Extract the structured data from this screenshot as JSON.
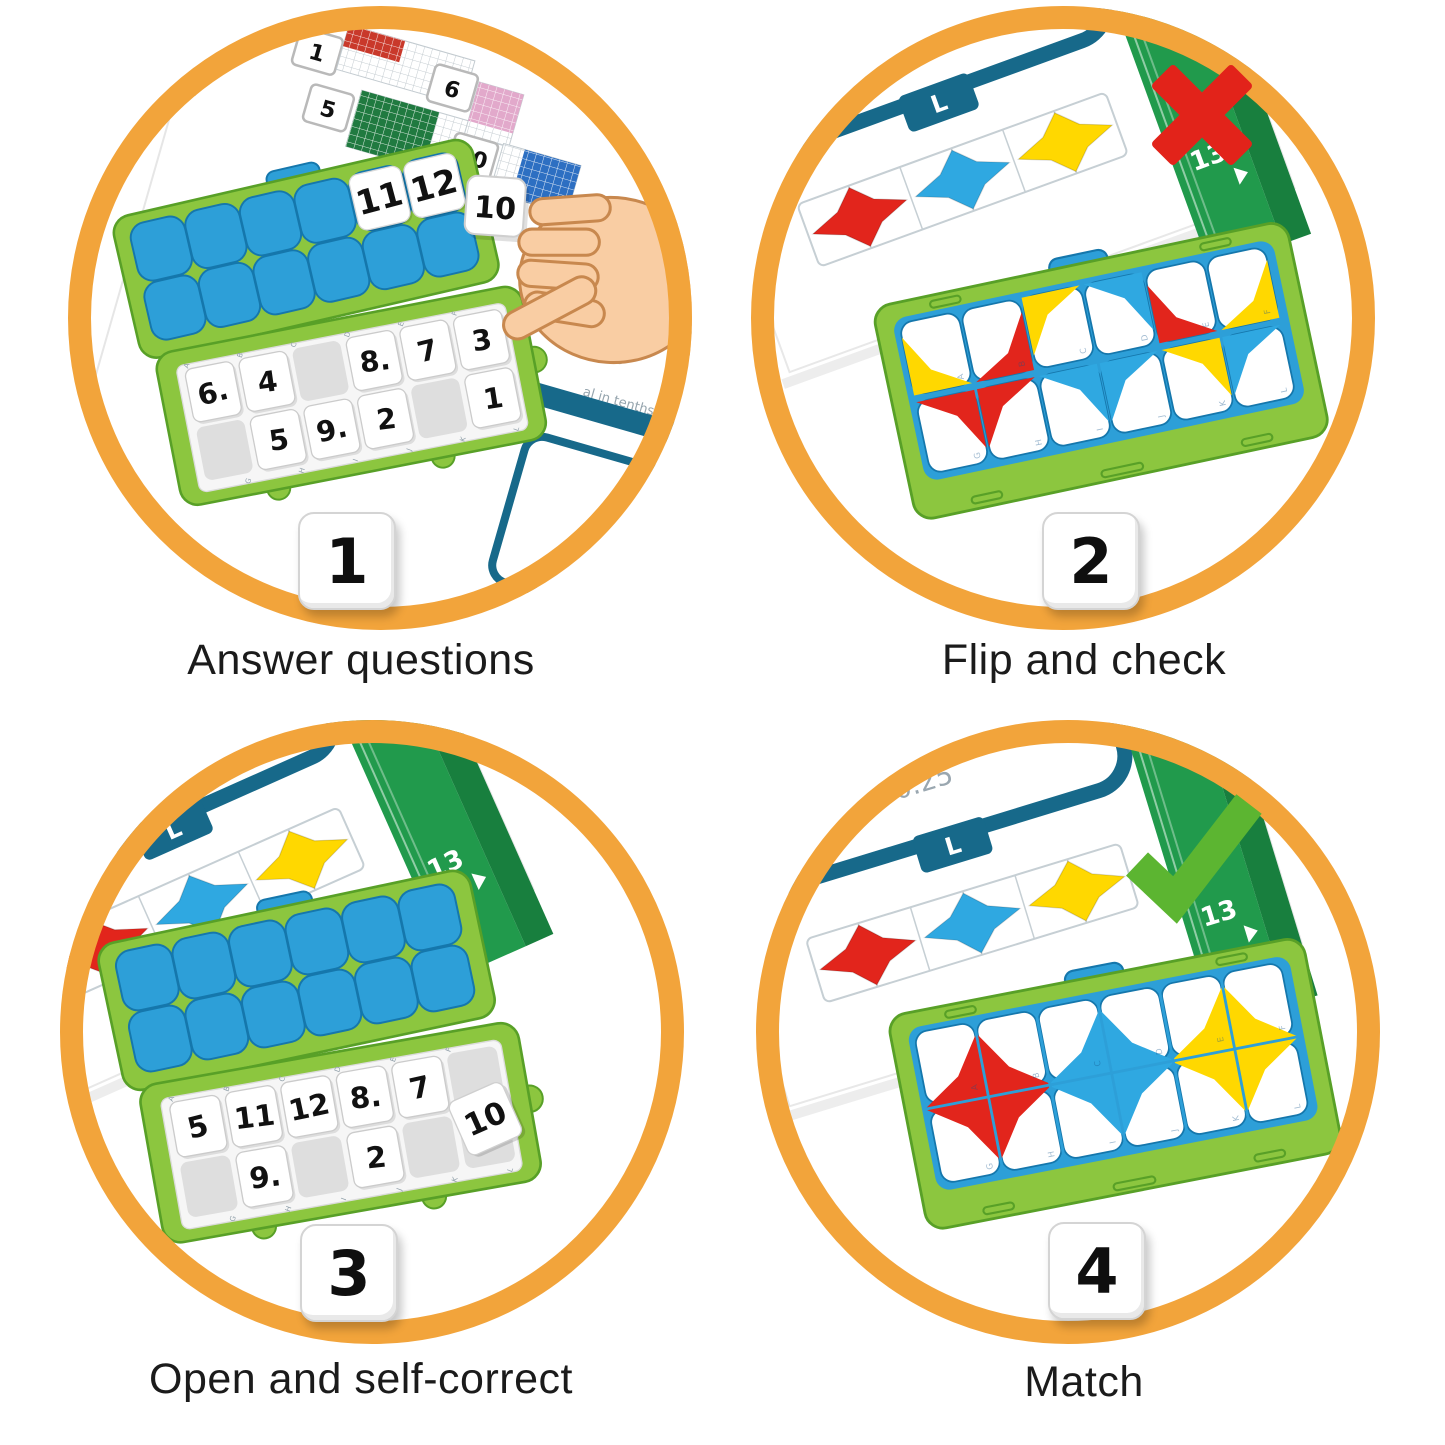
{
  "steps": [
    {
      "number": "1",
      "caption": "Answer questions"
    },
    {
      "number": "2",
      "caption": "Flip and check",
      "mark": "cross"
    },
    {
      "number": "3",
      "caption": "Open and self-correct"
    },
    {
      "number": "4",
      "caption": "Match",
      "mark": "check"
    }
  ],
  "colors": {
    "ring": "#F2A43B",
    "case_green": "#8CC63F",
    "case_green_dark": "#58A027",
    "lid_blue": "#2D9FD8",
    "lid_blue_dark": "#1577AC",
    "slot_gray": "#DEDEDE",
    "tray_bg": "#F6F6F6",
    "tile_border": "#CBCBCB",
    "star_red": "#E2251C",
    "star_blue": "#2FA8E1",
    "star_yellow": "#FFD800",
    "teal": "#17698A",
    "band_green": "#219A4C",
    "band_green_dark": "#187F3E",
    "cross_red": "#E2231A",
    "check_green": "#5CB531",
    "page_grid_red": "#C9392B",
    "page_grid_green": "#207A40",
    "page_grid_pink": "#E2A9CB",
    "page_grid_blue": "#2D6FC2",
    "skin": "#F9CDA3",
    "skin_line": "#C8884E",
    "muted_text": "#9AA7B0",
    "caption_text": "#1B1B1B"
  },
  "tile_letters": [
    "A",
    "B",
    "C",
    "D",
    "E",
    "F",
    "G",
    "H",
    "I",
    "J",
    "K",
    "L"
  ],
  "step1": {
    "page": {
      "labels": {
        "q1": "1",
        "q5": "5",
        "q6": "6",
        "q10": "10"
      },
      "fraction_denominator": "100",
      "equation": "= 0.25",
      "decimal_value": "0.75",
      "fraction2_denominator": "100",
      "note": "al in tenths",
      "band_letter": "I"
    },
    "hand_tile": "10",
    "case": {
      "lid_numbers": {
        "4": "11",
        "5": "12"
      },
      "tray_top": [
        "6.",
        "4",
        "",
        "8.",
        "7",
        "3"
      ],
      "tray_bottom": [
        "",
        "5",
        "9.",
        "2",
        "",
        "1"
      ]
    }
  },
  "step2": {
    "card": {
      "fraction_denominator": "100",
      "equation": "= 0.25",
      "tab": "L",
      "page_num": "13",
      "stars": [
        "star_red",
        "star_blue",
        "star_yellow"
      ]
    },
    "board": {
      "quarters": [
        {
          "col": 0,
          "row": 0,
          "corner": "bl",
          "color": "star_yellow"
        },
        {
          "col": 1,
          "row": 0,
          "corner": "br",
          "color": "star_red"
        },
        {
          "col": 2,
          "row": 0,
          "corner": "tl",
          "color": "star_yellow"
        },
        {
          "col": 3,
          "row": 0,
          "corner": "tr",
          "color": "star_blue"
        },
        {
          "col": 4,
          "row": 0,
          "corner": "bl",
          "color": "star_red"
        },
        {
          "col": 5,
          "row": 0,
          "corner": "br",
          "color": "star_yellow"
        },
        {
          "col": 0,
          "row": 1,
          "corner": "tr",
          "color": "star_red"
        },
        {
          "col": 1,
          "row": 1,
          "corner": "tl",
          "color": "star_red"
        },
        {
          "col": 2,
          "row": 1,
          "corner": "tr",
          "color": "star_blue"
        },
        {
          "col": 3,
          "row": 1,
          "corner": "tl",
          "color": "star_blue"
        },
        {
          "col": 4,
          "row": 1,
          "corner": "tr",
          "color": "star_yellow"
        },
        {
          "col": 5,
          "row": 1,
          "corner": "tl",
          "color": "star_blue"
        }
      ]
    }
  },
  "step3": {
    "card": {
      "tab": "L",
      "page_num": "13",
      "stars": [
        "star_red",
        "star_blue",
        "star_yellow"
      ]
    },
    "case": {
      "lid_numbers": {},
      "tray_top": [
        "5",
        "11",
        "12",
        "8.",
        "7",
        ""
      ],
      "tray_bottom": [
        "",
        "9.",
        "",
        "2",
        "",
        ""
      ],
      "loose_tile": "10"
    }
  },
  "step4": {
    "card": {
      "fraction_denominator": "100",
      "equation": "= 0.25",
      "tab": "L",
      "page_num": "13",
      "stars": [
        "star_red",
        "star_blue",
        "star_yellow"
      ]
    },
    "board": {
      "stars": [
        {
          "cx": 1,
          "cy": 1,
          "color": "star_red"
        },
        {
          "cx": 3,
          "cy": 1,
          "color": "star_blue"
        },
        {
          "cx": 5,
          "cy": 1,
          "color": "star_yellow"
        }
      ]
    }
  }
}
